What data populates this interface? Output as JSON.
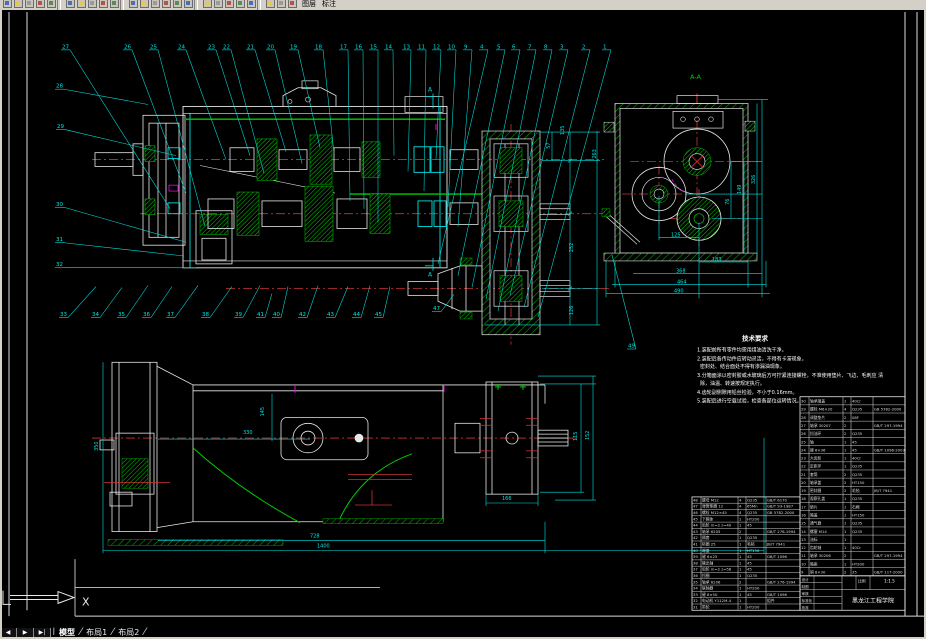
{
  "window": {
    "chrome_color": "#d4d0c8",
    "canvas_color": "#000000"
  },
  "toolbar": {
    "icons": [
      "new",
      "open",
      "save",
      "print",
      "preview",
      "spell",
      "cut",
      "copy",
      "paste",
      "match-properties",
      "undo",
      "redo",
      "pan",
      "zoom-realtime",
      "zoom-window",
      "zoom-previous",
      "distance",
      "area",
      "layer-manager",
      "layer-state",
      "properties",
      "text-style",
      "dim-style",
      "table-style"
    ],
    "right_labels": [
      "图层",
      "标注"
    ]
  },
  "tabs": {
    "nav_buttons": [
      "◀",
      "▶",
      "▶|"
    ],
    "items": [
      {
        "label": "模型",
        "active": true
      },
      {
        "label": "布局1",
        "active": false
      },
      {
        "label": "布局2",
        "active": false
      }
    ]
  },
  "ucs": {
    "x_label": "X"
  },
  "colors": {
    "cyan": "#00e5e5",
    "green": "#00cc00",
    "red": "#cc3333",
    "bright_red": "#ff2222",
    "magenta": "#ee00ee",
    "white": "#e8e8e8"
  },
  "drawing": {
    "callouts": {
      "top_y": 44,
      "top": [
        [
          "27",
          62,
          170,
          212
        ],
        [
          "26",
          124,
          186,
          196
        ],
        [
          "25",
          150,
          205,
          230
        ],
        [
          "24",
          178,
          226,
          162
        ],
        [
          "23",
          208,
          250,
          158
        ],
        [
          "22",
          223,
          264,
          176
        ],
        [
          "21",
          247,
          286,
          154
        ],
        [
          "20",
          267,
          302,
          166
        ],
        [
          "19",
          290,
          320,
          150
        ],
        [
          "18",
          315,
          334,
          156
        ],
        [
          "17",
          340,
          350,
          204
        ],
        [
          "16",
          355,
          364,
          212
        ],
        [
          "15",
          370,
          378,
          226
        ],
        [
          "14",
          385,
          394,
          158
        ],
        [
          "13",
          403,
          408,
          174
        ],
        [
          "11",
          418,
          424,
          194
        ],
        [
          "12",
          433,
          436,
          162
        ],
        [
          "10",
          448,
          448,
          210
        ],
        [
          "9",
          464,
          458,
          230
        ],
        [
          "4",
          480,
          438,
          268
        ],
        [
          "5",
          497,
          458,
          280
        ],
        [
          "6",
          512,
          472,
          292
        ],
        [
          "7",
          528,
          486,
          304
        ],
        [
          "8",
          544,
          498,
          316
        ],
        [
          "3",
          560,
          510,
          300
        ],
        [
          "2",
          582,
          524,
          312
        ],
        [
          "1",
          603,
          538,
          322
        ]
      ],
      "left": [
        [
          "28",
          56,
          84,
          148,
          106
        ],
        [
          "29",
          57,
          125,
          176,
          158
        ],
        [
          "30",
          56,
          204,
          186,
          246
        ],
        [
          "31",
          56,
          240,
          184,
          260
        ],
        [
          "32",
          56,
          265,
          196,
          272
        ]
      ],
      "bottom_y": 316,
      "bottom": [
        [
          "33",
          60,
          96,
          291
        ],
        [
          "34",
          92,
          122,
          292
        ],
        [
          "35",
          118,
          148,
          290
        ],
        [
          "36",
          143,
          172,
          291
        ],
        [
          "37",
          167,
          198,
          290
        ],
        [
          "38",
          202,
          232,
          291
        ],
        [
          "39",
          235,
          260,
          290
        ],
        [
          "41",
          257,
          272,
          298
        ],
        [
          "40",
          273,
          288,
          291
        ],
        [
          "42",
          299,
          318,
          290
        ],
        [
          "43",
          327,
          348,
          291
        ],
        [
          "44",
          353,
          370,
          290
        ],
        [
          "45",
          375,
          390,
          291
        ]
      ],
      "misc": [
        [
          "47",
          433,
          310,
          454,
          299
        ],
        [
          "49",
          628,
          348,
          612,
          259
        ]
      ]
    },
    "texts": [
      {
        "t": "A-A",
        "x": 690,
        "y": 80,
        "c": "#00cc00",
        "s": 6.5
      },
      {
        "t": "A",
        "x": 428,
        "y": 93,
        "s": 6
      },
      {
        "t": "A",
        "x": 428,
        "y": 281,
        "s": 6
      },
      {
        "t": "135",
        "x": 564,
        "y": 137,
        "r": 90
      },
      {
        "t": "57",
        "x": 550,
        "y": 151,
        "r": 90
      },
      {
        "t": "263",
        "x": 596,
        "y": 161,
        "r": 90
      },
      {
        "t": "252",
        "x": 573,
        "y": 256,
        "r": 90
      },
      {
        "t": "126",
        "x": 573,
        "y": 320,
        "r": 90
      },
      {
        "t": "125",
        "x": 671,
        "y": 240
      },
      {
        "t": "183",
        "x": 712,
        "y": 265
      },
      {
        "t": "368",
        "x": 676,
        "y": 277
      },
      {
        "t": "464",
        "x": 677,
        "y": 288
      },
      {
        "t": "490",
        "x": 674,
        "y": 297
      },
      {
        "t": "76",
        "x": 729,
        "y": 208,
        "r": 90
      },
      {
        "t": "149",
        "x": 741,
        "y": 197,
        "r": 90
      },
      {
        "t": "326",
        "x": 755,
        "y": 187,
        "r": 90
      },
      {
        "t": "330",
        "x": 243,
        "y": 441
      },
      {
        "t": "145",
        "x": 264,
        "y": 423,
        "r": 90
      },
      {
        "t": "350",
        "x": 98,
        "y": 458,
        "r": 90
      },
      {
        "t": "728",
        "x": 310,
        "y": 546
      },
      {
        "t": "1400",
        "x": 317,
        "y": 556
      },
      {
        "t": "166",
        "x": 502,
        "y": 508
      },
      {
        "t": "115",
        "x": 577,
        "y": 448,
        "r": 90
      },
      {
        "t": "152",
        "x": 589,
        "y": 447,
        "r": 90
      },
      {
        "t": "X",
        "x": 82,
        "y": 615,
        "s": 11,
        "c": "#e8e8e8"
      }
    ],
    "notes": {
      "title": "技术要求",
      "title_x": 742,
      "title_y": 346,
      "items": [
        {
          "t": "1.装配前所有零件均需用煤油清洗干净。",
          "x": 697,
          "y": 357
        },
        {
          "t": "2.装配后各传动件应转动灵活，不得有卡滞现象，",
          "x": 697,
          "y": 366
        },
        {
          "t": "密封处、结合面处不得有渗漏油现象。",
          "x": 700,
          "y": 374
        },
        {
          "t": "3.分箱面涂以密封胶或水玻璃后方可拧紧连接螺栓，不准使用垫片、飞边、毛刺应 清",
          "x": 697,
          "y": 383
        },
        {
          "t": "除，油温、转速按规定执行。",
          "x": 700,
          "y": 391
        },
        {
          "t": "4.齿轮副侧隙用铅丝检验，不小于0.16mm。",
          "x": 697,
          "y": 400
        },
        {
          "t": "5.装配后进行空载试验，检查各部位运转情况。",
          "x": 697,
          "y": 409
        }
      ]
    },
    "bom": {
      "right": {
        "x": 800,
        "y": 403,
        "row_h": 8.27,
        "col_w": [
          9,
          34,
          8,
          22,
          32
        ],
        "rows": [
          [
            "30",
            "轴承端盖",
            "1",
            "40Cr",
            ""
          ],
          [
            "29",
            "螺栓 M6×20",
            "4",
            "Q235",
            "GB 5782-2000"
          ],
          [
            "28",
            "调整垫片",
            "2",
            "08F",
            ""
          ],
          [
            "27",
            "轴承 30207",
            "2",
            "",
            "GB/T 297-1994"
          ],
          [
            "26",
            "挡油环",
            "2",
            "Q235",
            ""
          ],
          [
            "25",
            "轴",
            "1",
            "45",
            ""
          ],
          [
            "24",
            "键 8×36",
            "1",
            "45",
            "GB/T 1096-2003"
          ],
          [
            "23",
            "大齿轮",
            "1",
            "40Cr",
            ""
          ],
          [
            "22",
            "定距环",
            "1",
            "Q235",
            ""
          ],
          [
            "21",
            "套筒",
            "2",
            "Q235",
            ""
          ],
          [
            "20",
            "轴承盖",
            "2",
            "HT150",
            ""
          ],
          [
            "19",
            "密封圈",
            "2",
            "毛毡",
            "JB/T 7941"
          ],
          [
            "18",
            "观察孔盖",
            "1",
            "Q235",
            ""
          ],
          [
            "17",
            "垫片",
            "1",
            "石棉",
            ""
          ],
          [
            "16",
            "箱盖",
            "1",
            "HT150",
            ""
          ],
          [
            "15",
            "通气器",
            "1",
            "Q235",
            ""
          ],
          [
            "14",
            "螺塞 M14",
            "1",
            "Q235",
            ""
          ],
          [
            "13",
            "油标",
            "1",
            "",
            ""
          ],
          [
            "12",
            "齿轮轴",
            "1",
            "40Cr",
            ""
          ],
          [
            "11",
            "轴承 30206",
            "2",
            "",
            "GB/T 297-1994"
          ],
          [
            "10",
            "箱座",
            "1",
            "HT200",
            ""
          ],
          [
            "9",
            "销 8×30",
            "2",
            "35",
            "GB/T 117-2000"
          ]
        ]
      },
      "left": {
        "x": 692,
        "y": 504.8,
        "row_h": 6.4,
        "col_w": [
          9,
          37,
          8,
          20,
          34
        ],
        "rows": [
          [
            "48",
            "螺母 M12",
            "4",
            "Q235",
            "GB/T 6170"
          ],
          [
            "47",
            "弹簧垫圈 12",
            "4",
            "65Mn",
            "GB/T 93-1987"
          ],
          [
            "46",
            "螺栓 M12×45",
            "4",
            "Q235",
            "GB 5782-2000"
          ],
          [
            "45",
            "下箱体",
            "1",
            "HT200",
            ""
          ],
          [
            "44",
            "齿轮 m=2 z=40",
            "1",
            "45",
            ""
          ],
          [
            "43",
            "轴承 6205",
            "2",
            "",
            "GB/T 276-1994"
          ],
          [
            "42",
            "隔套",
            "1",
            "Q235",
            ""
          ],
          [
            "41",
            "毡圈 25",
            "1",
            "毛毡",
            "JB/T 7941"
          ],
          [
            "40",
            "端盖",
            "1",
            "HT150",
            ""
          ],
          [
            "39",
            "键 6×25",
            "1",
            "45",
            "GB/T 1096"
          ],
          [
            "38",
            "输出轴",
            "1",
            "45",
            ""
          ],
          [
            "37",
            "齿轮 m=2 z=58",
            "1",
            "45",
            ""
          ],
          [
            "36",
            "挡圈",
            "1",
            "Q235",
            ""
          ],
          [
            "35",
            "轴承 6206",
            "2",
            "",
            "GB/T 276-1994"
          ],
          [
            "34",
            "联轴器",
            "1",
            "HT200",
            ""
          ],
          [
            "33",
            "键 8×50",
            "1",
            "45",
            "GB/T 1096"
          ],
          [
            "32",
            "电动机 Y112M-4",
            "1",
            "",
            "组件"
          ],
          [
            "31",
            "带轮",
            "1",
            "HT200",
            ""
          ]
        ]
      }
    },
    "title_block": {
      "school": "黑龙江工程学院",
      "scale_label": "比例",
      "scale": "1:1.5",
      "fields": [
        "设计",
        "制图",
        "审核",
        "标准化",
        "批准"
      ]
    }
  }
}
